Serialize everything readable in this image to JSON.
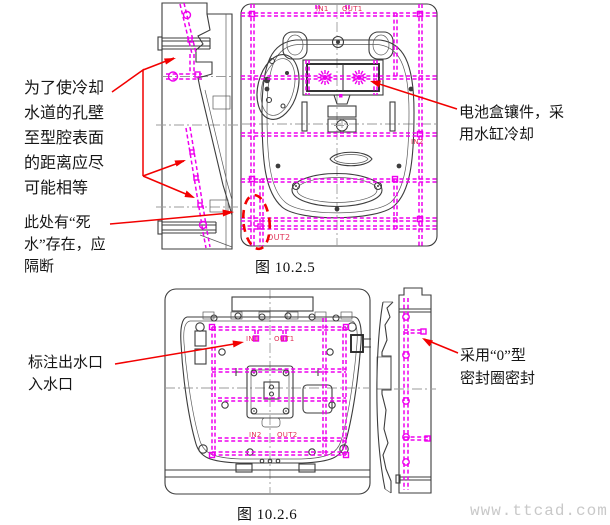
{
  "colors": {
    "coolant_magenta": "#ee00ee",
    "annotation_red": "#f20000",
    "linework": "#3d3d3d",
    "centerline": "#9b9b9b",
    "port_label": "#e03358",
    "watermark": "#c9c9c9"
  },
  "figure1": {
    "caption": "图 10.2.5",
    "labels": {
      "in1": "IN1",
      "out1": "OUT1",
      "in2": "IN2",
      "out2": "OUT2"
    },
    "annotations": {
      "cooling_wall": {
        "lines": [
          "为了使冷却",
          "水道的孔壁",
          "至型腔表面",
          "的距离应尽",
          "可能相等"
        ]
      },
      "dead_water": {
        "lines": [
          "此处有“死",
          "水”存在，应",
          "隔断"
        ]
      },
      "battery_insert": {
        "lines": [
          "电池盒镶件，采",
          "用水缸冷却"
        ]
      }
    }
  },
  "figure2": {
    "caption": "图 10.2.6",
    "labels": {
      "in1": "IN1",
      "out1": "OUT1",
      "in2": "IN2",
      "out2": "OUT2"
    },
    "annotations": {
      "ports": {
        "lines": [
          "标注出水口",
          "入水口"
        ]
      },
      "seal": {
        "lines": [
          "采用“0”型",
          "密封圈密封"
        ]
      }
    }
  },
  "watermark": "www.ttcad.com"
}
